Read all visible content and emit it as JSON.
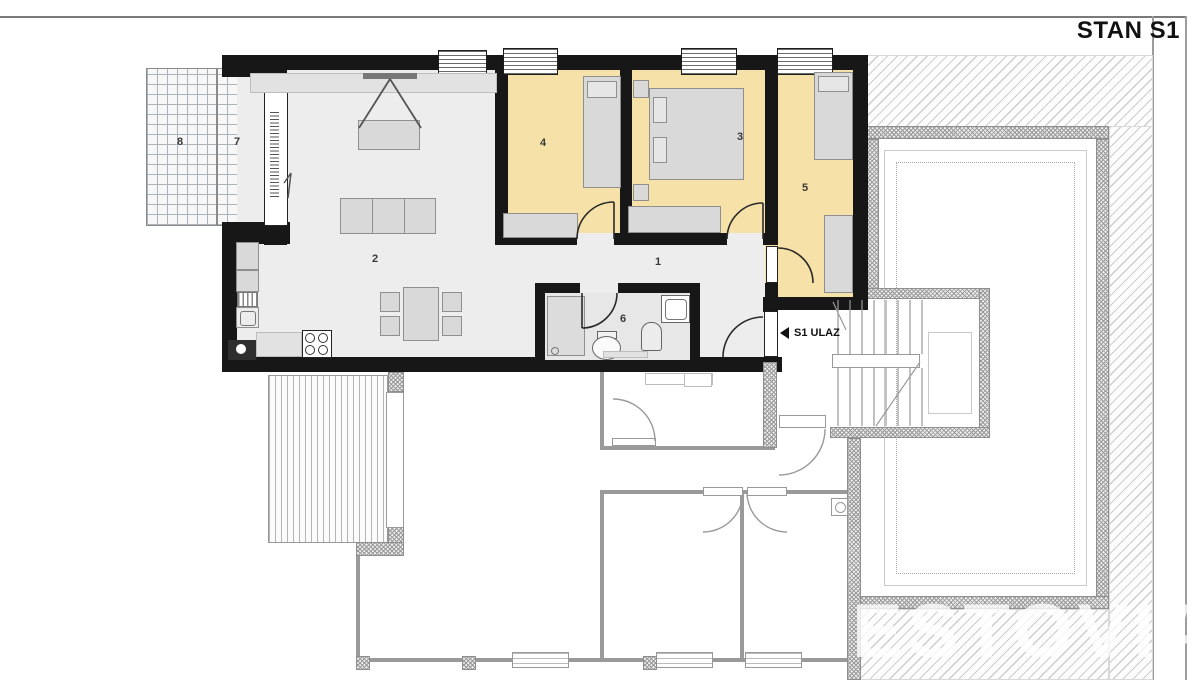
{
  "title": "STAN S1",
  "entrance": {
    "label": "S1 ULAZ"
  },
  "watermark": "ESTOVIA",
  "room_labels": {
    "hallway": "1",
    "living_dining": "2",
    "bedroom_a": "3",
    "bedroom_b": "4",
    "bedroom_c": "5",
    "bathroom": "6",
    "terrace_front": "7",
    "terrace_side": "8"
  },
  "colors": {
    "wall": "#171717",
    "bedroom_floor": "#f6e2a8",
    "living_floor": "#ededed",
    "hatch_line": "#cdcdcd",
    "title_text": "#111111",
    "watermark_text": "rgba(255,255,255,0.78)"
  }
}
